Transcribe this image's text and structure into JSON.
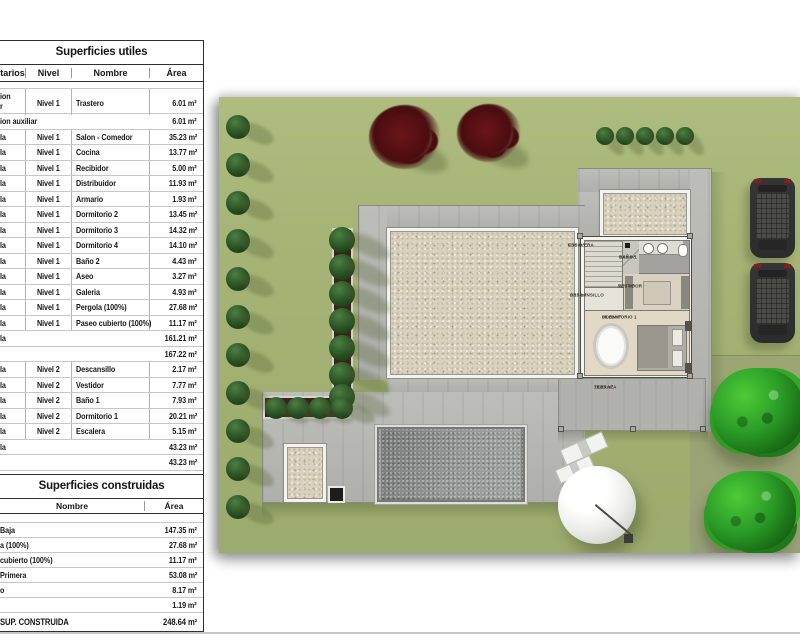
{
  "table_utiles": {
    "title": "Superficies utiles",
    "headers": {
      "owner": "tarios",
      "level": "Nivel",
      "name": "Nombre",
      "area": "Área"
    },
    "rows": [
      {
        "t": "d2",
        "o1": "ion",
        "o2": "r",
        "l": "Nivel 1",
        "n": "Trastero",
        "a": "6.01 m²"
      },
      {
        "t": "s",
        "o": "ion auxiliar",
        "a": "6.01 m²"
      },
      {
        "t": "d",
        "o": "la",
        "l": "Nivel 1",
        "n": "Salon - Comedor",
        "a": "35.23 m²"
      },
      {
        "t": "d",
        "o": "la",
        "l": "Nivel 1",
        "n": "Cocina",
        "a": "13.77 m²"
      },
      {
        "t": "d",
        "o": "la",
        "l": "Nivel 1",
        "n": "Recibidor",
        "a": "5.00 m²"
      },
      {
        "t": "d",
        "o": "la",
        "l": "Nivel 1",
        "n": "Distribuidor",
        "a": "11.93 m²"
      },
      {
        "t": "d",
        "o": "la",
        "l": "Nivel 1",
        "n": "Armario",
        "a": "1.93 m²"
      },
      {
        "t": "d",
        "o": "la",
        "l": "Nivel 1",
        "n": "Dormitorio 2",
        "a": "13.45 m²"
      },
      {
        "t": "d",
        "o": "la",
        "l": "Nivel 1",
        "n": "Dormitorio 3",
        "a": "14.32 m²"
      },
      {
        "t": "d",
        "o": "la",
        "l": "Nivel 1",
        "n": "Dormitorio 4",
        "a": "14.10 m²"
      },
      {
        "t": "d",
        "o": "la",
        "l": "Nivel 1",
        "n": "Baño 2",
        "a": "4.43 m²"
      },
      {
        "t": "d",
        "o": "la",
        "l": "Nivel 1",
        "n": "Aseo",
        "a": "3.27 m²"
      },
      {
        "t": "d",
        "o": "la",
        "l": "Nivel 1",
        "n": "Galeria",
        "a": "4.93 m²"
      },
      {
        "t": "d",
        "o": "la",
        "l": "Nivel 1",
        "n": "Pergola (100%)",
        "a": "27.68 m²"
      },
      {
        "t": "d",
        "o": "la",
        "l": "Nivel 1",
        "n": "Paseo cubierto (100%)",
        "a": "11.17 m²"
      },
      {
        "t": "s",
        "o": "la",
        "a": "161.21 m²"
      },
      {
        "t": "s",
        "o": "",
        "a": "167.22 m²"
      },
      {
        "t": "d",
        "o": "la",
        "l": "Nivel 2",
        "n": "Descansillo",
        "a": "2.17 m²"
      },
      {
        "t": "d",
        "o": "la",
        "l": "Nivel 2",
        "n": "Vestidor",
        "a": "7.77 m²"
      },
      {
        "t": "d",
        "o": "la",
        "l": "Nivel 2",
        "n": "Baño 1",
        "a": "7.93 m²"
      },
      {
        "t": "d",
        "o": "la",
        "l": "Nivel 2",
        "n": "Dormitorio 1",
        "a": "20.21 m²"
      },
      {
        "t": "d",
        "o": "la",
        "l": "Nivel 2",
        "n": "Escalera",
        "a": "5.15 m²"
      },
      {
        "t": "s",
        "o": "la",
        "a": "43.23 m²"
      },
      {
        "t": "s",
        "o": "",
        "a": "43.23 m²"
      },
      {
        "t": "total",
        "o": "SUPERFICIE UTIL",
        "a": "210.45 m²"
      }
    ]
  },
  "table_construidas": {
    "title": "Superficies construidas",
    "headers": {
      "name": "Nombre",
      "area": "Área"
    },
    "rows": [
      {
        "t": "d",
        "n": "Baja",
        "a": "147.35 m²"
      },
      {
        "t": "d",
        "n": "a (100%)",
        "a": "27.68 m²"
      },
      {
        "t": "d",
        "n": "cubierto (100%)",
        "a": "11.17 m²"
      },
      {
        "t": "d",
        "n": "Primera",
        "a": "53.08 m²"
      },
      {
        "t": "d",
        "n": "o",
        "a": "8.17 m²"
      },
      {
        "t": "d",
        "n": "",
        "a": "1.19 m²"
      },
      {
        "t": "total",
        "n": "SUP. CONSTRUIDA",
        "a": "248.64 m²"
      }
    ]
  },
  "plan": {
    "rooms": [
      {
        "name": "ESCALERA",
        "area": "5.15 m²"
      },
      {
        "name": "BAÑO 1",
        "area": "7.93 m²"
      },
      {
        "name": "VESTIDOR",
        "area": "7.77 m²"
      },
      {
        "name": "DESCANSILLO",
        "area": "2.17 m²"
      },
      {
        "name": "DORMITORIO 1",
        "area": "20.21 m²"
      },
      {
        "name": "TERRAZA",
        "area": "19.25 m²"
      }
    ],
    "colors": {
      "lawn": "#a4b473",
      "paving": "#b8b8b4",
      "gravel": "#d7d1be",
      "pool": "#8b8f8d",
      "hedge_green": "#24461f",
      "tree_red": "#4a0d11",
      "tree_green": "#2a9b28"
    }
  }
}
